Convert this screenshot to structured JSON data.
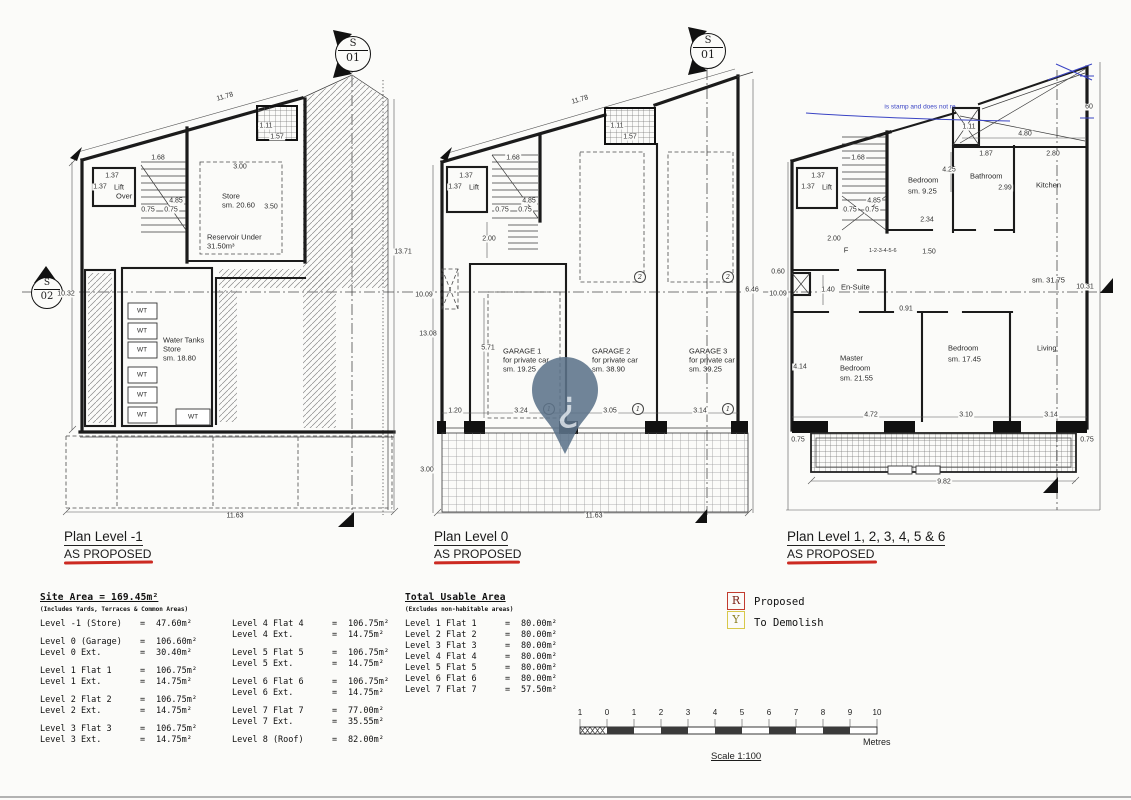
{
  "watermark": {
    "pin_glyph": "¿",
    "stamp_text": "is stamp and does not re"
  },
  "markers": [
    {
      "top": "S",
      "bottom": "01"
    },
    {
      "top": "S",
      "bottom": "01"
    },
    {
      "top": "S",
      "bottom": "02"
    }
  ],
  "plans": [
    {
      "title": "Plan Level -1",
      "subtitle": "AS PROPOSED",
      "labels": [
        {
          "t": "11.78",
          "x": 225,
          "y": 97,
          "k": "d",
          "rot": -16
        },
        {
          "t": "1.11",
          "x": 266,
          "y": 126,
          "k": "d"
        },
        {
          "t": "1.57",
          "x": 277,
          "y": 137,
          "k": "d"
        },
        {
          "t": "1.68",
          "x": 158,
          "y": 158,
          "k": "d"
        },
        {
          "t": "1.37",
          "x": 112,
          "y": 176,
          "k": "d"
        },
        {
          "t": "1.37",
          "x": 100,
          "y": 187,
          "k": "d"
        },
        {
          "t": "Lift",
          "x": 114,
          "y": 187,
          "k": "r",
          "a": "l"
        },
        {
          "t": "Over",
          "x": 116,
          "y": 196,
          "k": "r",
          "a": "l"
        },
        {
          "t": "4.85",
          "x": 176,
          "y": 201,
          "k": "d"
        },
        {
          "t": "0.75",
          "x": 148,
          "y": 210,
          "k": "d"
        },
        {
          "t": "0.75",
          "x": 171,
          "y": 210,
          "k": "d"
        },
        {
          "t": "3.00",
          "x": 240,
          "y": 167,
          "k": "d"
        },
        {
          "t": "Store",
          "x": 222,
          "y": 196,
          "k": "r",
          "a": "l"
        },
        {
          "t": "sm. 20.60",
          "x": 222,
          "y": 205,
          "k": "r",
          "a": "l"
        },
        {
          "t": "3.50",
          "x": 271,
          "y": 207,
          "k": "d"
        },
        {
          "t": "Reservoir Under",
          "x": 207,
          "y": 237,
          "k": "r",
          "a": "l"
        },
        {
          "t": "31.50m³",
          "x": 207,
          "y": 246,
          "k": "r",
          "a": "l"
        },
        {
          "t": "13.71",
          "x": 403,
          "y": 252,
          "k": "d"
        },
        {
          "t": "10.32",
          "x": 66,
          "y": 294,
          "k": "d"
        },
        {
          "t": "Water Tanks",
          "x": 163,
          "y": 340,
          "k": "r",
          "a": "l"
        },
        {
          "t": "Store",
          "x": 163,
          "y": 349,
          "k": "r",
          "a": "l"
        },
        {
          "t": "sm. 18.80",
          "x": 163,
          "y": 358,
          "k": "r",
          "a": "l"
        },
        {
          "t": "WT",
          "x": 142,
          "y": 311,
          "k": "w"
        },
        {
          "t": "WT",
          "x": 142,
          "y": 331,
          "k": "w"
        },
        {
          "t": "WT",
          "x": 142,
          "y": 350,
          "k": "w"
        },
        {
          "t": "WT",
          "x": 142,
          "y": 375,
          "k": "w"
        },
        {
          "t": "WT",
          "x": 142,
          "y": 395,
          "k": "w"
        },
        {
          "t": "WT",
          "x": 142,
          "y": 415,
          "k": "w"
        },
        {
          "t": "WT",
          "x": 193,
          "y": 417,
          "k": "w"
        },
        {
          "t": "11.63",
          "x": 235,
          "y": 516,
          "k": "d"
        }
      ]
    },
    {
      "title": "Plan Level 0",
      "subtitle": "AS PROPOSED",
      "labels": [
        {
          "t": "11.78",
          "x": 580,
          "y": 100,
          "k": "d",
          "rot": -16
        },
        {
          "t": "1.11",
          "x": 617,
          "y": 126,
          "k": "d"
        },
        {
          "t": "1.57",
          "x": 630,
          "y": 137,
          "k": "d"
        },
        {
          "t": "1.68",
          "x": 513,
          "y": 158,
          "k": "d"
        },
        {
          "t": "1.37",
          "x": 466,
          "y": 176,
          "k": "d"
        },
        {
          "t": "1.37",
          "x": 455,
          "y": 187,
          "k": "d"
        },
        {
          "t": "Lift",
          "x": 469,
          "y": 187,
          "k": "r",
          "a": "l"
        },
        {
          "t": "4.85",
          "x": 529,
          "y": 201,
          "k": "d"
        },
        {
          "t": "0.75",
          "x": 502,
          "y": 210,
          "k": "d"
        },
        {
          "t": "0.75",
          "x": 525,
          "y": 210,
          "k": "d"
        },
        {
          "t": "2.00",
          "x": 489,
          "y": 239,
          "k": "d"
        },
        {
          "t": "10.09",
          "x": 424,
          "y": 295,
          "k": "d"
        },
        {
          "t": "13.08",
          "x": 428,
          "y": 334,
          "k": "d"
        },
        {
          "t": "6.46",
          "x": 752,
          "y": 290,
          "k": "d"
        },
        {
          "t": "5.71",
          "x": 488,
          "y": 348,
          "k": "d"
        },
        {
          "t": "GARAGE 1",
          "x": 503,
          "y": 351,
          "k": "r",
          "a": "l"
        },
        {
          "t": "for private car",
          "x": 503,
          "y": 360,
          "k": "r",
          "a": "l"
        },
        {
          "t": "sm. 19.25",
          "x": 503,
          "y": 369,
          "k": "r",
          "a": "l"
        },
        {
          "t": "GARAGE 2",
          "x": 592,
          "y": 351,
          "k": "r",
          "a": "l"
        },
        {
          "t": "for private car",
          "x": 592,
          "y": 360,
          "k": "r",
          "a": "l"
        },
        {
          "t": "sm. 38.90",
          "x": 592,
          "y": 369,
          "k": "r",
          "a": "l"
        },
        {
          "t": "GARAGE 3",
          "x": 689,
          "y": 351,
          "k": "r",
          "a": "l"
        },
        {
          "t": "for private car",
          "x": 689,
          "y": 360,
          "k": "r",
          "a": "l"
        },
        {
          "t": "sm. 39.25",
          "x": 689,
          "y": 369,
          "k": "r",
          "a": "l"
        },
        {
          "t": "1.20",
          "x": 455,
          "y": 411,
          "k": "d"
        },
        {
          "t": "3.24",
          "x": 521,
          "y": 411,
          "k": "d"
        },
        {
          "t": "1",
          "x": 549,
          "y": 409,
          "k": "c"
        },
        {
          "t": "3.05",
          "x": 610,
          "y": 411,
          "k": "d"
        },
        {
          "t": "1",
          "x": 638,
          "y": 409,
          "k": "c"
        },
        {
          "t": "3.14",
          "x": 700,
          "y": 411,
          "k": "d"
        },
        {
          "t": "1",
          "x": 728,
          "y": 409,
          "k": "c"
        },
        {
          "t": "2",
          "x": 640,
          "y": 277,
          "k": "c"
        },
        {
          "t": "2",
          "x": 728,
          "y": 277,
          "k": "c"
        },
        {
          "t": "3.00",
          "x": 427,
          "y": 470,
          "k": "d"
        },
        {
          "t": "11.63",
          "x": 594,
          "y": 516,
          "k": "d"
        }
      ]
    },
    {
      "title": "Plan Level 1, 2, 3, 4, 5 & 6",
      "subtitle": "AS PROPOSED",
      "labels": [
        {
          "t": "1.68",
          "x": 858,
          "y": 158,
          "k": "d"
        },
        {
          "t": "1.37",
          "x": 818,
          "y": 176,
          "k": "d"
        },
        {
          "t": "1.37",
          "x": 808,
          "y": 187,
          "k": "d"
        },
        {
          "t": "Lift",
          "x": 822,
          "y": 187,
          "k": "r",
          "a": "l"
        },
        {
          "t": "4.85",
          "x": 874,
          "y": 201,
          "k": "d"
        },
        {
          "t": "0.75",
          "x": 850,
          "y": 210,
          "k": "d"
        },
        {
          "t": "0.75",
          "x": 872,
          "y": 210,
          "k": "d"
        },
        {
          "t": "2.00",
          "x": 834,
          "y": 239,
          "k": "d"
        },
        {
          "t": "F",
          "x": 846,
          "y": 250,
          "k": "r"
        },
        {
          "t": "1-2-3-4-5-6",
          "x": 869,
          "y": 251,
          "k": "t",
          "a": "l"
        },
        {
          "t": "1.11",
          "x": 969,
          "y": 127,
          "k": "d"
        },
        {
          "t": "4.80",
          "x": 1025,
          "y": 134,
          "k": "d"
        },
        {
          "t": "60",
          "x": 1089,
          "y": 107,
          "k": "d"
        },
        {
          "t": "Bedroom",
          "x": 908,
          "y": 180,
          "k": "r",
          "a": "l"
        },
        {
          "t": "sm. 9.25",
          "x": 908,
          "y": 191,
          "k": "r",
          "a": "l"
        },
        {
          "t": "4.25",
          "x": 949,
          "y": 170,
          "k": "d"
        },
        {
          "t": "Bathroom",
          "x": 970,
          "y": 176,
          "k": "r",
          "a": "l"
        },
        {
          "t": "1.87",
          "x": 986,
          "y": 154,
          "k": "d"
        },
        {
          "t": "2.99",
          "x": 1005,
          "y": 188,
          "k": "d"
        },
        {
          "t": "2.80",
          "x": 1053,
          "y": 154,
          "k": "d"
        },
        {
          "t": "Kitchen",
          "x": 1036,
          "y": 185,
          "k": "r",
          "a": "l"
        },
        {
          "t": "2.34",
          "x": 927,
          "y": 220,
          "k": "d"
        },
        {
          "t": "1.50",
          "x": 929,
          "y": 252,
          "k": "d"
        },
        {
          "t": "0.60",
          "x": 778,
          "y": 272,
          "k": "d"
        },
        {
          "t": "10.09",
          "x": 778,
          "y": 294,
          "k": "d"
        },
        {
          "t": "En-Suite",
          "x": 841,
          "y": 287,
          "k": "r",
          "a": "l"
        },
        {
          "t": "1.40",
          "x": 828,
          "y": 290,
          "k": "d"
        },
        {
          "t": "sm. 31.75",
          "x": 1032,
          "y": 280,
          "k": "r",
          "a": "l"
        },
        {
          "t": "10.31",
          "x": 1085,
          "y": 287,
          "k": "d"
        },
        {
          "t": "0.91",
          "x": 906,
          "y": 309,
          "k": "d"
        },
        {
          "t": "Master",
          "x": 840,
          "y": 358,
          "k": "r",
          "a": "l"
        },
        {
          "t": "Bedroom",
          "x": 840,
          "y": 368,
          "k": "r",
          "a": "l"
        },
        {
          "t": "sm. 21.55",
          "x": 840,
          "y": 378,
          "k": "r",
          "a": "l"
        },
        {
          "t": "4.14",
          "x": 800,
          "y": 367,
          "k": "d"
        },
        {
          "t": "Bedroom",
          "x": 948,
          "y": 348,
          "k": "r",
          "a": "l"
        },
        {
          "t": "sm. 17.45",
          "x": 948,
          "y": 359,
          "k": "r",
          "a": "l"
        },
        {
          "t": "Living",
          "x": 1037,
          "y": 348,
          "k": "r",
          "a": "l"
        },
        {
          "t": "4.72",
          "x": 871,
          "y": 415,
          "k": "d"
        },
        {
          "t": "3.10",
          "x": 966,
          "y": 415,
          "k": "d"
        },
        {
          "t": "3.14",
          "x": 1051,
          "y": 415,
          "k": "d"
        },
        {
          "t": "0.75",
          "x": 798,
          "y": 440,
          "k": "d"
        },
        {
          "t": "0.75",
          "x": 1087,
          "y": 440,
          "k": "d"
        },
        {
          "t": "9.82",
          "x": 944,
          "y": 482,
          "k": "d"
        }
      ]
    }
  ],
  "tables": {
    "site": {
      "header": "Site Area = 169.45m²",
      "note": "(Includes Yards, Terraces & Common Areas)",
      "eq": "=",
      "col1": [
        [
          [
            "Level -1 (Store)",
            "47.60m²"
          ]
        ],
        [
          [
            "Level 0 (Garage)",
            "106.60m²"
          ],
          [
            "Level 0 Ext.",
            "30.40m²"
          ]
        ],
        [
          [
            "Level 1 Flat 1",
            "106.75m²"
          ],
          [
            "Level 1 Ext.",
            "14.75m²"
          ]
        ],
        [
          [
            "Level 2 Flat 2",
            "106.75m²"
          ],
          [
            "Level 2 Ext.",
            "14.75m²"
          ]
        ],
        [
          [
            "Level 3 Flat 3",
            "106.75m²"
          ],
          [
            "Level 3 Ext.",
            "14.75m²"
          ]
        ]
      ],
      "col2": [
        [
          [
            "Level 4 Flat 4",
            "106.75m²"
          ],
          [
            "Level 4 Ext.",
            "14.75m²"
          ]
        ],
        [
          [
            "Level 5 Flat 5",
            "106.75m²"
          ],
          [
            "Level 5 Ext.",
            "14.75m²"
          ]
        ],
        [
          [
            "Level 6 Flat 6",
            "106.75m²"
          ],
          [
            "Level 6 Ext.",
            "14.75m²"
          ]
        ],
        [
          [
            "Level 7 Flat 7",
            "77.00m²"
          ],
          [
            "Level 7 Ext.",
            "35.55m²"
          ]
        ],
        [
          [
            "Level 8 (Roof)",
            "82.00m²"
          ]
        ]
      ]
    },
    "usable": {
      "header": "Total Usable Area",
      "note": "(Excludes non-habitable areas)",
      "eq": "=",
      "col1": [
        [
          [
            "Level 1 Flat 1",
            "80.00m²"
          ],
          [
            "Level 2 Flat 2",
            "80.00m²"
          ],
          [
            "Level 3 Flat 3",
            "80.00m²"
          ],
          [
            "Level 4 Flat 4",
            "80.00m²"
          ],
          [
            "Level 5 Flat 5",
            "80.00m²"
          ],
          [
            "Level 6 Flat 6",
            "80.00m²"
          ],
          [
            "Level 7 Flat 7",
            "57.50m²"
          ]
        ]
      ]
    }
  },
  "legend": {
    "items": [
      {
        "symbol": "R",
        "label": "Proposed",
        "color": "#c23b2e"
      },
      {
        "symbol": "Y",
        "label": "To Demolish",
        "color": "#d8c84a"
      }
    ]
  },
  "scale": {
    "ticks": [
      {
        "t": "1",
        "x": 580
      },
      {
        "t": "0",
        "x": 607
      },
      {
        "t": "1",
        "x": 634
      },
      {
        "t": "2",
        "x": 661
      },
      {
        "t": "3",
        "x": 688
      },
      {
        "t": "4",
        "x": 715
      },
      {
        "t": "5",
        "x": 742
      },
      {
        "t": "6",
        "x": 769
      },
      {
        "t": "7",
        "x": 796
      },
      {
        "t": "8",
        "x": 823
      },
      {
        "t": "9",
        "x": 850
      },
      {
        "t": "10",
        "x": 877
      }
    ],
    "unit": "Metres",
    "caption": "Scale 1:100"
  }
}
